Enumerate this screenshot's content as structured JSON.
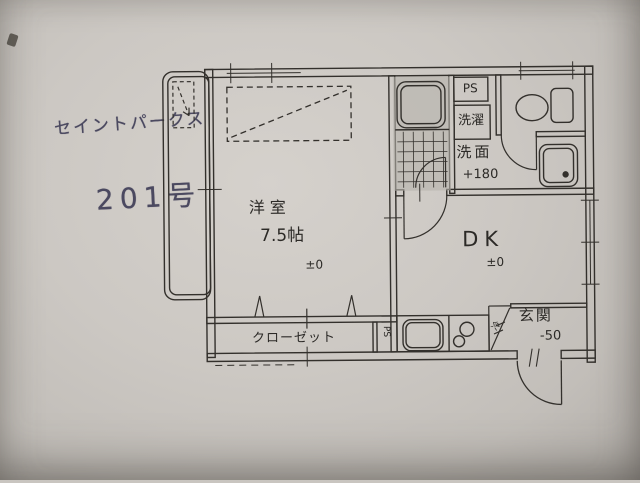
{
  "annotation": {
    "building_name": "セイントパークス",
    "unit_number": "201号"
  },
  "rooms": {
    "western_room": {
      "label": "洋室",
      "size": "7.5帖",
      "level": "±0"
    },
    "dining_kitchen": {
      "label": "DK",
      "level": "±0"
    },
    "closet": {
      "label": "クローゼット"
    },
    "washroom": {
      "label": "洗面",
      "level": "+180"
    },
    "laundry": {
      "label": "洗濯"
    },
    "entrance": {
      "label": "玄関",
      "level": "-50"
    },
    "pipe_space_top": {
      "label": "PS"
    },
    "pipe_space_bottom": {
      "label": "PS"
    },
    "refrigerator": {
      "label": "冷"
    }
  },
  "colors": {
    "paper": "#c9c5c0",
    "ink": "#33302c",
    "handwriting": "#4b4960",
    "bath_tint": "#b5b2ab"
  }
}
